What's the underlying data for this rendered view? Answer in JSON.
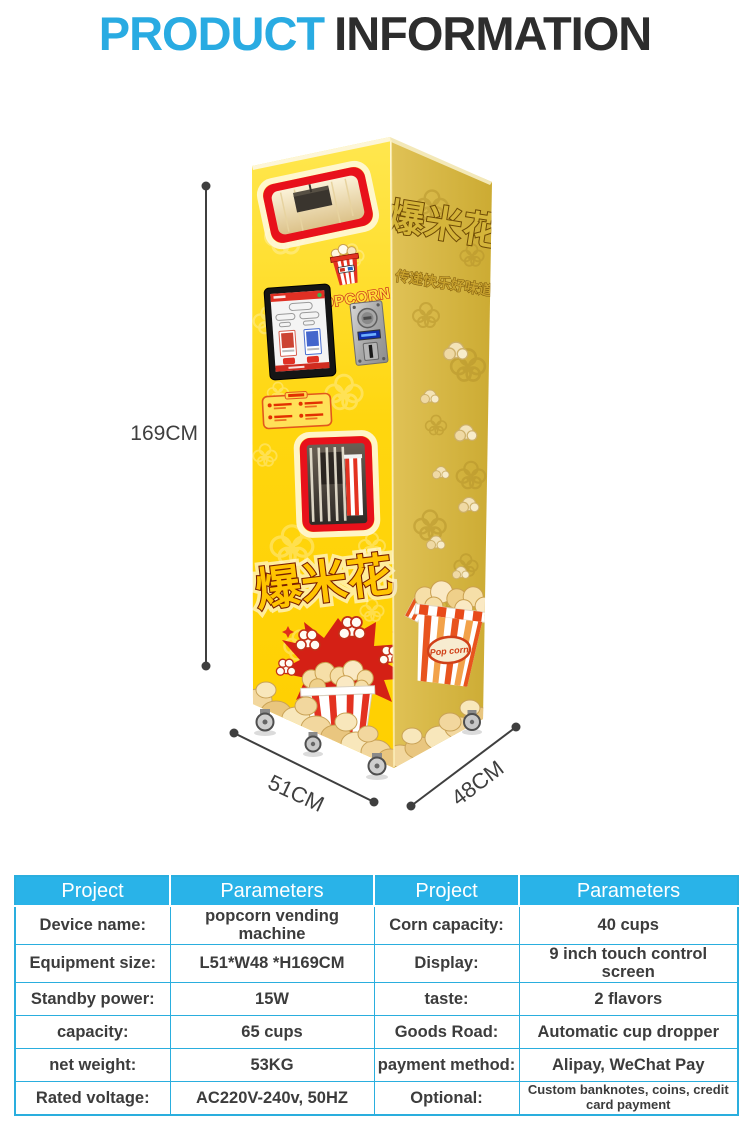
{
  "title": {
    "part1": "PRODUCT",
    "part2": "INFORMATION"
  },
  "colors": {
    "accent": "#29abe2",
    "table_header": "#29b3e8",
    "table_border": "#2aaede",
    "machine_front_yellow": "#ffd60f",
    "machine_side_yellow": "#d8b845",
    "window_border_red": "#e8111b",
    "dimension_line": "#3f3f3f"
  },
  "machine": {
    "height_label": "169CM",
    "width_label": "51CM",
    "depth_label": "48CM",
    "front_cjk": "爆米花",
    "side_cjk": "爆米花",
    "side_subtitle": "传递快乐好味道",
    "logo_text": "POPCORN",
    "bucket_label": "Pop corn"
  },
  "table": {
    "headers": [
      "Project",
      "Parameters",
      "Project",
      "Parameters"
    ],
    "rows": [
      {
        "c1": "Device name:",
        "c2": "popcorn vending machine",
        "c3": "Corn capacity:",
        "c4": "40 cups"
      },
      {
        "c1": "Equipment size:",
        "c2": "L51*W48 *H169CM",
        "c3": "Display:",
        "c4": "9 inch touch control screen"
      },
      {
        "c1": "Standby power:",
        "c2": "15W",
        "c3": "taste:",
        "c4": "2 flavors"
      },
      {
        "c1": "capacity:",
        "c2": "65 cups",
        "c3": "Goods Road:",
        "c4": "Automatic cup dropper"
      },
      {
        "c1": "net weight:",
        "c2": "53KG",
        "c3": "payment method:",
        "c4": "Alipay, WeChat Pay"
      },
      {
        "c1": "Rated voltage:",
        "c2": "AC220V-240v, 50HZ",
        "c3": "Optional:",
        "c4": "Custom banknotes, coins, credit card payment"
      }
    ]
  }
}
